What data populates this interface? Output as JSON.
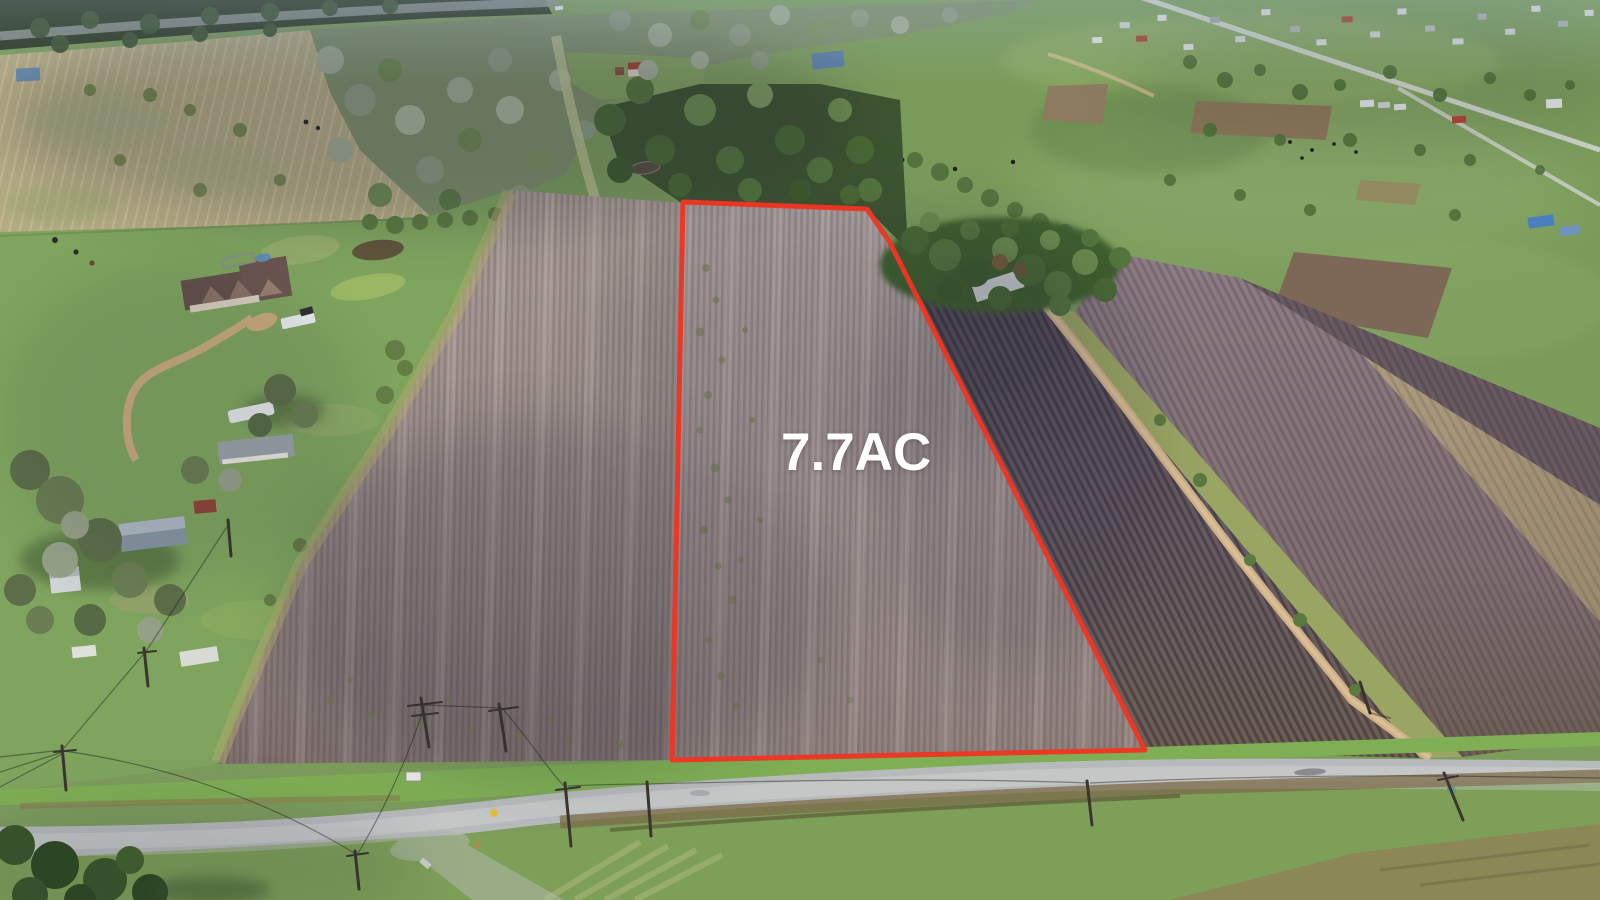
{
  "image": {
    "kind": "aerial drone photograph",
    "subject": "7.7 acre tilled farmland parcel outlined in red beside a rural county road with homesteads and pastures",
    "parcel_label": "7.7AC",
    "label_color": "#ffffff",
    "boundary_color": "#ee3524",
    "palette": {
      "tilled_parcel": "#a69896",
      "tilled_field_west": "#9a8c88",
      "tilled_field_east_dark": "#645966",
      "tilled_field_far": "#82727a",
      "pasture_green": "#7a9b5a",
      "lawn_green": "#7fa45e",
      "dry_grass_tan": "#b5ab84",
      "tree_green_dark": "#3f5c2e",
      "tree_green_pale": "#9fab92",
      "road_gray": "#b7babb",
      "dirt_path_tan": "#c9ae84",
      "weed_band_brown": "#7c6c49"
    }
  }
}
